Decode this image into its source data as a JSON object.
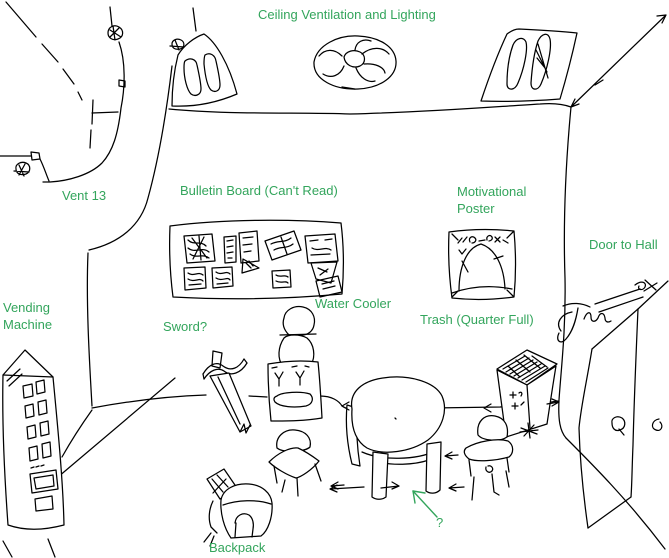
{
  "canvas": {
    "width": 669,
    "height": 558,
    "background_color": "#ffffff",
    "ink_color": "#000000",
    "label_color": "#33a55c"
  },
  "labels": {
    "ceiling_ventilation": "Ceiling Ventilation and Lighting",
    "vent_13": "Vent 13",
    "bulletin_board": "Bulletin Board (Can't Read)",
    "motivational_poster": "Motivational\nPoster",
    "door_to_hall": "Door to Hall",
    "vending_machine": "Vending\nMachine",
    "sword": "Sword?",
    "water_cooler": "Water Cooler",
    "trash": "Trash (Quarter Full)",
    "backpack": "Backpack",
    "table_question": "?"
  },
  "sketch_objects": [
    "ceiling-duct",
    "sprinkler-scribbles",
    "skylight-left",
    "ceiling-fan",
    "skylight-right",
    "bulletin-board",
    "motivational-poster",
    "water-cooler",
    "sword",
    "vending-machine",
    "round-table",
    "chair-left",
    "chair-right",
    "trash-can",
    "backpack",
    "door",
    "doorknob",
    "signature-scribble",
    "floor-arrows",
    "question-arrow"
  ]
}
